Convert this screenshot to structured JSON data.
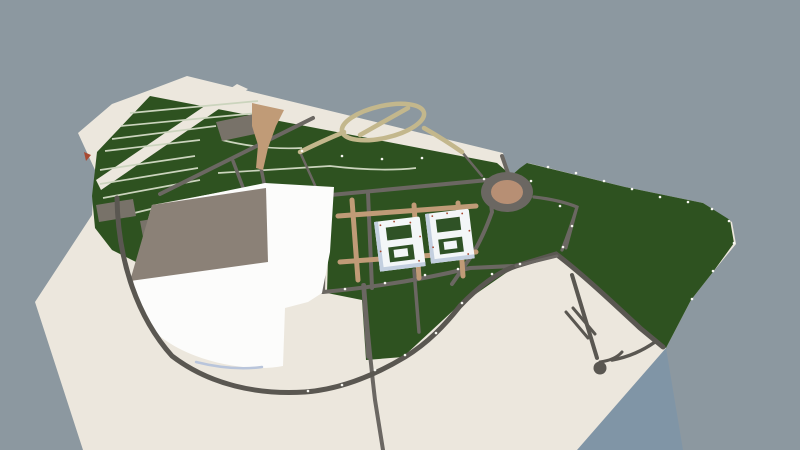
{
  "scene": {
    "title": "3D aerial view of a landscaped site-plan model"
  },
  "palette": {
    "sky": "#8C98A0",
    "terrain": "#ECE7DD",
    "terrain_side": "#8095A6",
    "grass": "#2E5220",
    "road": "#6B6762",
    "road_dark": "#5A5751",
    "path_tan": "#C09B77",
    "path_olive": "#C3B78C",
    "plot_line": "#CBD4BD",
    "plaza": "#8B8177",
    "shed": "#787269",
    "hall_white": "#FCFCFB",
    "hall_shadow": "#B9C5DB",
    "building_face": "#F3F6F8",
    "building_shade": "#C3CFDF",
    "courtyard": "#2F5226",
    "round_center": "#B78F74",
    "lamp": "#F8F8F2",
    "accent_red": "#A84A32"
  },
  "features": [
    {
      "name": "sky-background"
    },
    {
      "name": "terrain-slab"
    },
    {
      "name": "terrain-side-face"
    },
    {
      "name": "perimeter-strip"
    },
    {
      "name": "farm-plot-strips"
    },
    {
      "name": "plot-parking-lot"
    },
    {
      "name": "sheds",
      "count": 2
    },
    {
      "name": "dirt-fork-path"
    },
    {
      "name": "loop-trail"
    },
    {
      "name": "campus-road-grid"
    },
    {
      "name": "dirt-path-grid"
    },
    {
      "name": "twin-courtyard-buildings",
      "count": 2
    },
    {
      "name": "taupe-plaza"
    },
    {
      "name": "large-white-building"
    },
    {
      "name": "ring-road-arc"
    },
    {
      "name": "roundabout"
    },
    {
      "name": "east-meadow-trails"
    },
    {
      "name": "cul-de-sac-road"
    },
    {
      "name": "street-lamps"
    }
  ]
}
